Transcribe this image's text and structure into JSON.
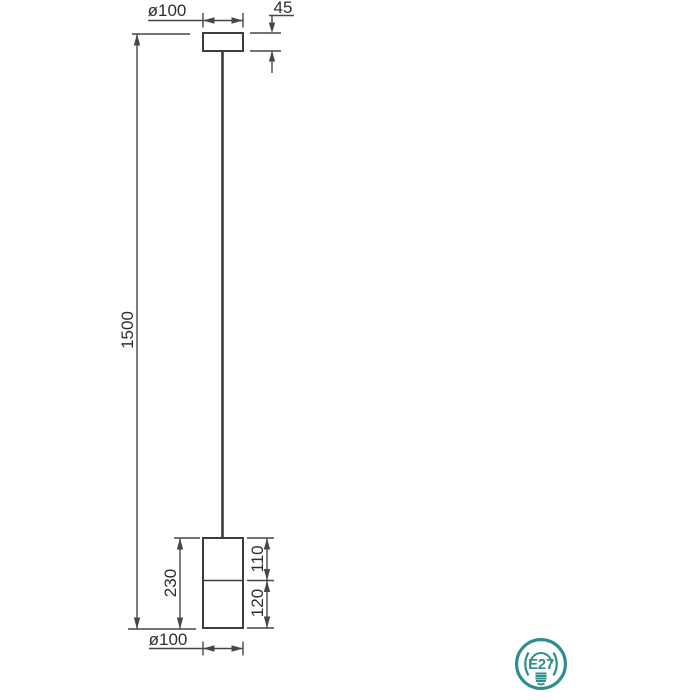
{
  "drawing": {
    "type": "pendant-lamp-dimension-diagram",
    "colors": {
      "line": "#474747",
      "text": "#2e2e2e",
      "accent_teal": "#2e8d8d",
      "background": "#ffffff"
    },
    "dimensions": {
      "canopy_diameter": "ø100",
      "canopy_height": "45",
      "overall_drop": "1500",
      "shade_height": "230",
      "shade_upper_section": "110",
      "shade_lower_section": "120",
      "shade_diameter": "ø100"
    },
    "socket": {
      "label": "E27"
    }
  }
}
